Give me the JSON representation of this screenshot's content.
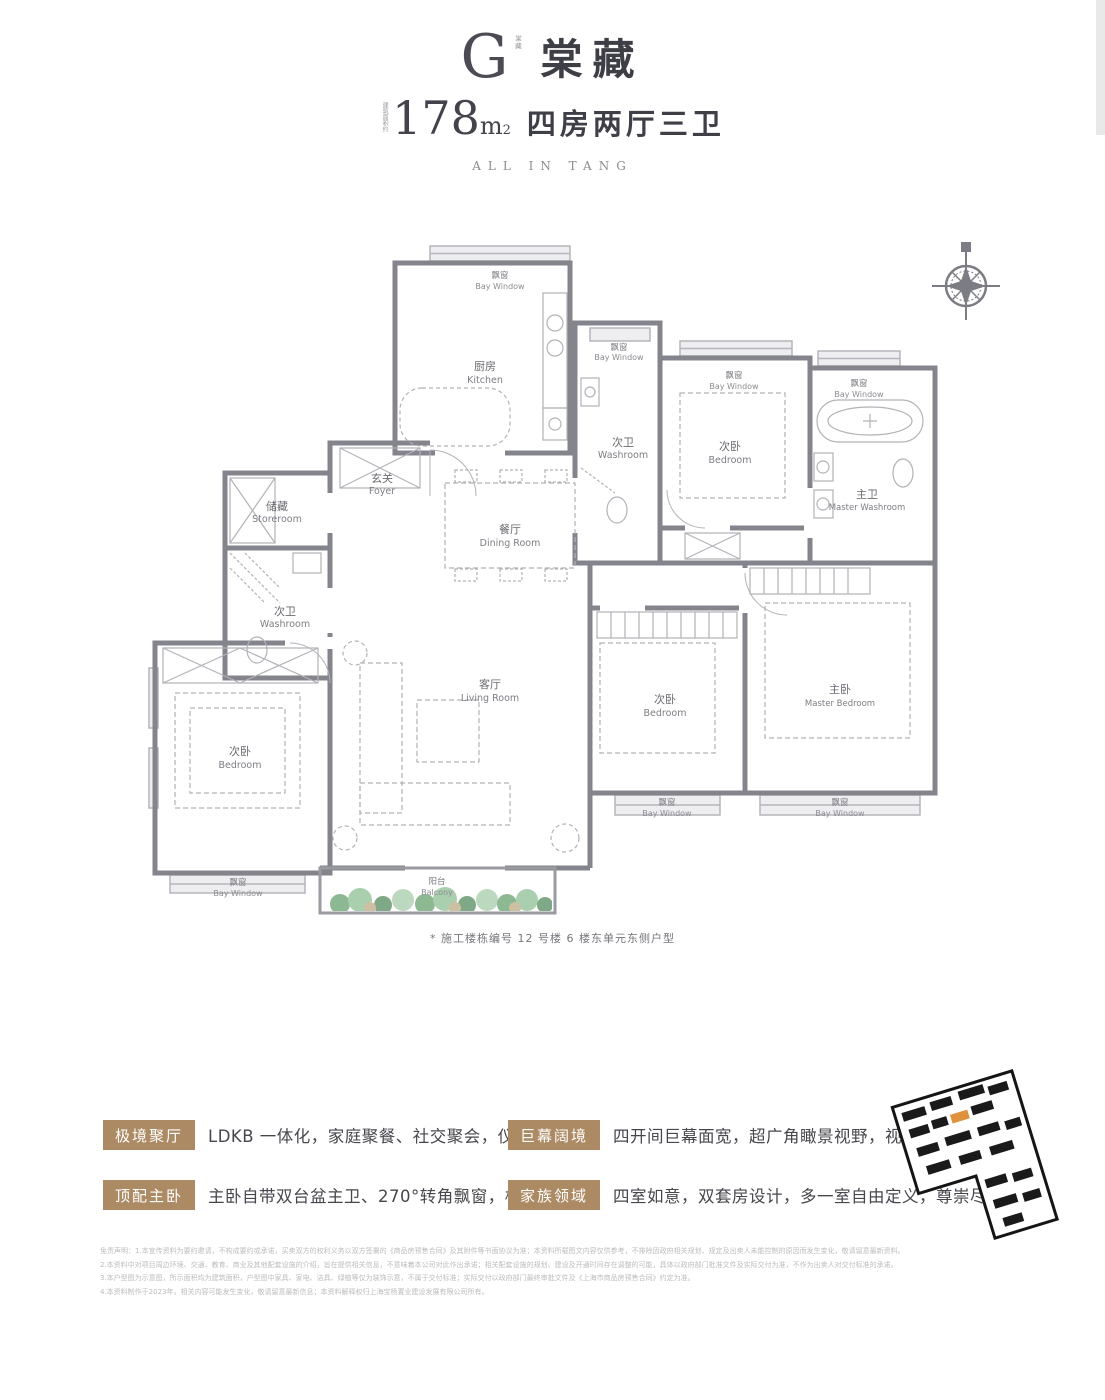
{
  "header": {
    "logo_letter": "G",
    "logo_vertical": "棠藏",
    "brand": "棠藏",
    "area_prefix": "建筑面积约",
    "area_number": "178",
    "area_unit": "m",
    "area_sup": "2",
    "layout_text": "四房两厅三卫",
    "subtitle_en": "ALL IN TANG"
  },
  "floorplan": {
    "note": "* 施工楼栋编号 12 号楼 6 楼东单元东侧户型",
    "rooms": [
      {
        "cn": "飘窗",
        "en": "Bay Window"
      },
      {
        "cn": "厨房",
        "en": "Kitchen"
      },
      {
        "cn": "飘窗",
        "en": "Bay Window"
      },
      {
        "cn": "次卫",
        "en": "Washroom"
      },
      {
        "cn": "飘窗",
        "en": "Bay Window"
      },
      {
        "cn": "飘窗",
        "en": "Bay Window"
      },
      {
        "cn": "次卧",
        "en": "Bedroom"
      },
      {
        "cn": "主卫",
        "en": "Master Washroom"
      },
      {
        "cn": "玄关",
        "en": "Foyer"
      },
      {
        "cn": "储藏",
        "en": "Storeroom"
      },
      {
        "cn": "餐厅",
        "en": "Dining Room"
      },
      {
        "cn": "次卫",
        "en": "Washroom"
      },
      {
        "cn": "客厅",
        "en": "Living Room"
      },
      {
        "cn": "次卧",
        "en": "Bedroom"
      },
      {
        "cn": "飘窗",
        "en": "Bay Window"
      },
      {
        "cn": "阳台",
        "en": "Balcony"
      },
      {
        "cn": "次卧",
        "en": "Bedroom"
      },
      {
        "cn": "主卧",
        "en": "Master Bedroom"
      },
      {
        "cn": "飘窗",
        "en": "Bay Window"
      },
      {
        "cn": "飘窗",
        "en": "Bay Window"
      }
    ]
  },
  "features": [
    {
      "tag": "极境聚厅",
      "desc": "LDKB 一体化，家庭聚餐、社交聚会，仪式感拉满"
    },
    {
      "tag": "巨幕阔境",
      "desc": "四开间巨幕面宽，超广角瞰景视野，视界一览无余"
    },
    {
      "tag": "顶配主卧",
      "desc": "主卧自带双台盆主卫、270°转角飘窗，极尽排场"
    },
    {
      "tag": "家族领域",
      "desc": "四室如意，双套房设计，多一室自由定义，尊崇尽显"
    }
  ],
  "disclaimer": {
    "lines": [
      "免责声明：1.本宣传资料为要约邀请，不构成要约或承诺，买卖双方的权利义务以双方签署的《商品房预售合同》及其附件等书面协议为准；本资料所载图文内容仅供参考，不排除因政府相关规划、规定及出卖人未能控制的原因而发生变化，敬请留意最新资料。",
      "2.本资料中对项目周边环境、交通、教育、商业及其他配套设施的介绍，旨在提供相关信息，不意味着本公司对此作出承诺；相关配套设施的规划、建设及开通时间存在调整的可能，具体以政府部门批准文件及实际交付为准，不作为出卖人对交付标准的承诺。",
      "3.本户型图为示意图，所示面积均为建筑面积，户型图中家具、家电、洁具、绿植等仅为装饰示意，不属于交付标准；实际交付以政府部门最终审批文件及《上海市商品房预售合同》约定为准。",
      "4.本资料制作于2023年，相关内容可能发生变化，敬请留意最新信息；本资料解释权归上海宝杨置业建设发展有限公司所有。"
    ]
  },
  "colors": {
    "tag_bg": "#ac8a63",
    "wall_gray": "#84848c",
    "window_gray": "#b5b5bb",
    "label_gray": "#6a6a71",
    "tree_green": "#8cb892",
    "siteplan_highlight": "#e0913c"
  }
}
